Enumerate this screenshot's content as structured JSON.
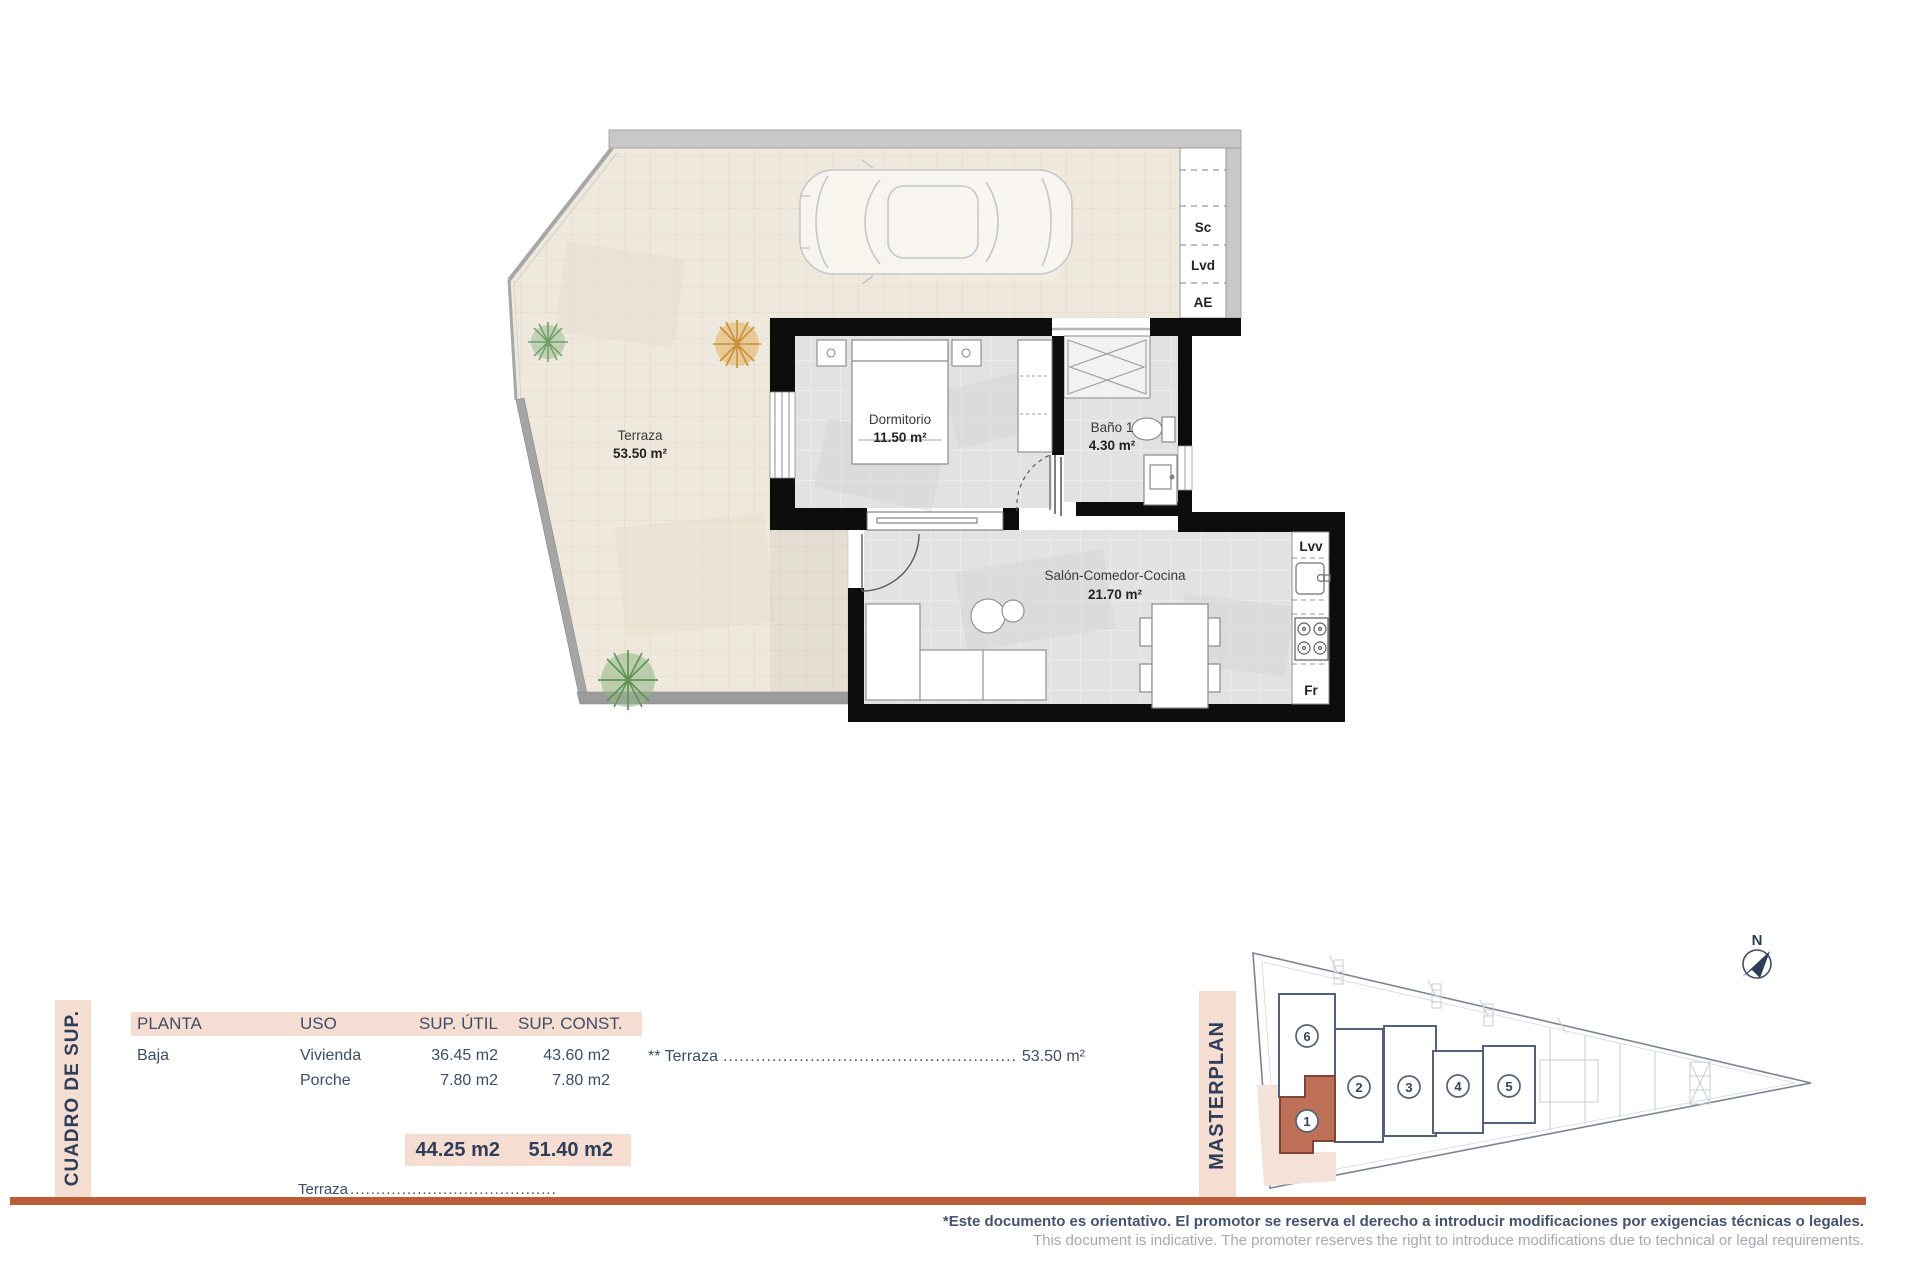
{
  "floor_plan": {
    "rooms": [
      {
        "name": "Terraza",
        "area": "53.50 m²"
      },
      {
        "name": "Dormitorio",
        "area": "11.50 m²"
      },
      {
        "name": "Baño 1",
        "area": "4.30 m²"
      },
      {
        "name": "Salón-Comedor-Cocina",
        "area": "21.70 m²"
      }
    ],
    "fixtures": {
      "sc": "Sc",
      "lvd": "Lvd",
      "ae": "AE",
      "lvv": "Lvv",
      "fr": "Fr"
    },
    "compass_label": "N"
  },
  "surface_table": {
    "side_title": "CUADRO DE SUP.",
    "headers": {
      "planta": "PLANTA",
      "uso": "USO",
      "sup_util": "SUP. ÚTIL",
      "sup_const": "SUP. CONST."
    },
    "rows": [
      {
        "planta": "Baja",
        "uso": "Vivienda",
        "util": "36.45 m2",
        "const": "43.60 m2"
      },
      {
        "planta": "",
        "uso": "Porche",
        "util": "7.80 m2",
        "const": "7.80 m2"
      }
    ],
    "totals": {
      "util": "44.25 m2",
      "const": "51.40 m2"
    },
    "terrace_note": {
      "prefix": "** Terraza",
      "dots": "........................................................................................................................",
      "value": "53.50 m²"
    },
    "bottom_row": {
      "label": "Terraza",
      "dots": "........................................................................"
    }
  },
  "masterplan": {
    "side_title": "MASTERPLAN",
    "units": [
      {
        "label": "1",
        "highlighted": true
      },
      {
        "label": "2",
        "highlighted": false
      },
      {
        "label": "3",
        "highlighted": false
      },
      {
        "label": "4",
        "highlighted": false
      },
      {
        "label": "5",
        "highlighted": false
      },
      {
        "label": "6",
        "highlighted": false
      }
    ]
  },
  "footer": {
    "line_es": "*Este documento es orientativo. El promotor se reserva el derecho a introducir modificaciones por exigencias técnicas o legales.",
    "line_en": "This document is indicative. The promoter reserves the right to introduce modifications due to technical or legal requirements."
  },
  "colors": {
    "accent_rule": "#bc5d38",
    "panel_pink": "#f6ddd2",
    "highlight_unit": "#bf7058",
    "ink": "#3d4d68"
  }
}
